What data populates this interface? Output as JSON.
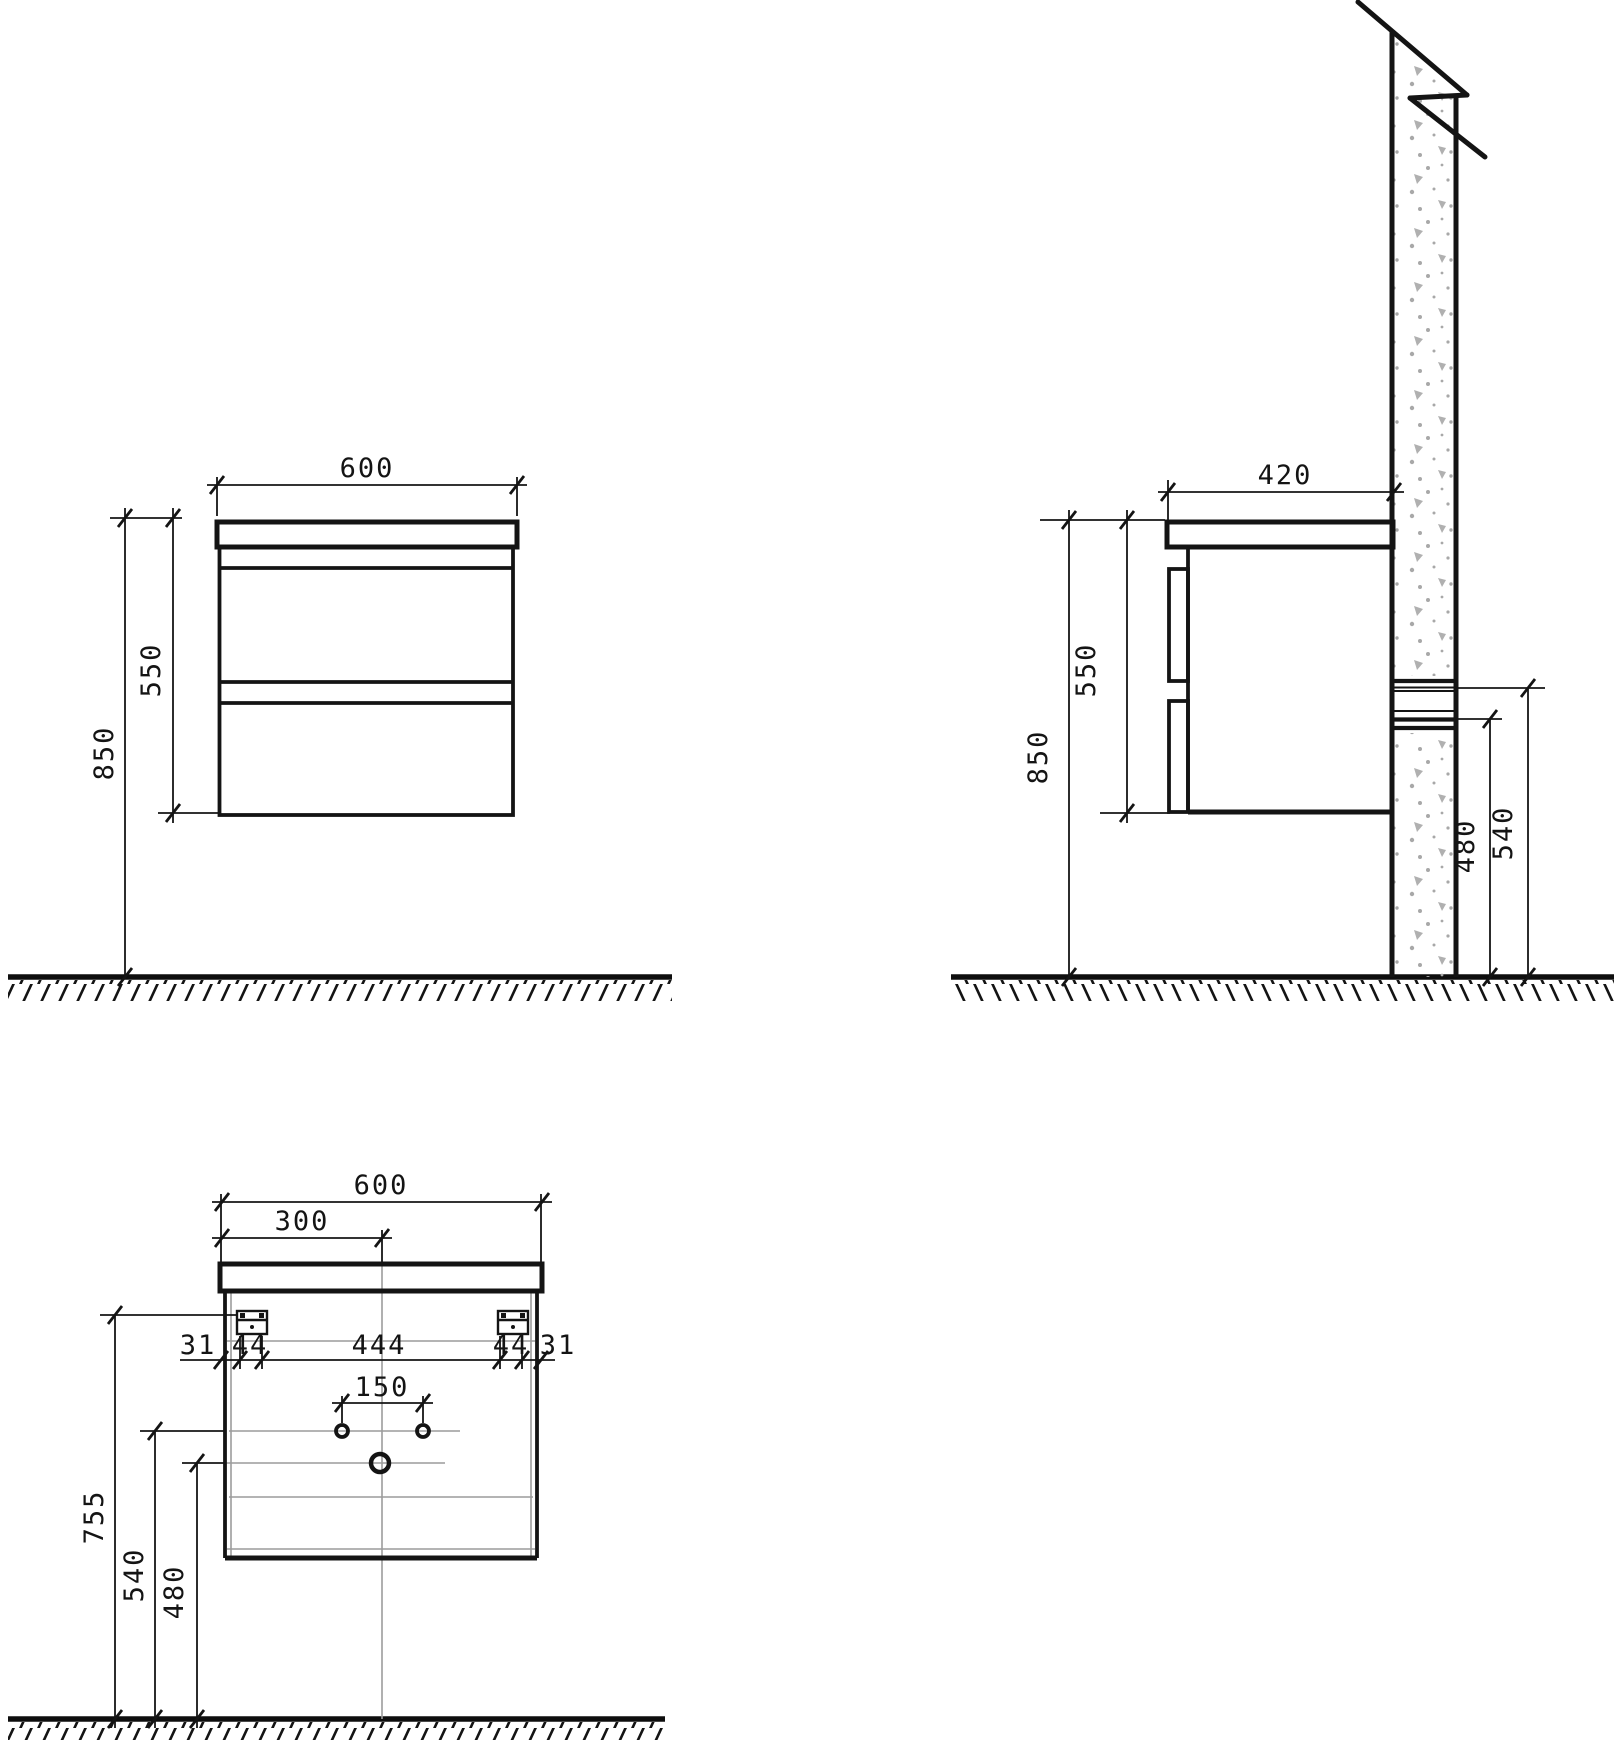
{
  "front_view": {
    "width": "600",
    "cabinet_height": "550",
    "mount_height": "850"
  },
  "side_view": {
    "depth": "420",
    "cabinet_height": "550",
    "mount_height": "850",
    "outlet_upper": "540",
    "outlet_lower": "480"
  },
  "back_view": {
    "width": "600",
    "center_offset": "300",
    "margin_left": "31",
    "bracket_left": "44",
    "bracket_span": "444",
    "bracket_right": "44",
    "margin_right": "31",
    "faucet_spacing": "150",
    "bracket_height": "755",
    "faucet_height": "540",
    "drain_height": "480"
  },
  "colors": {
    "line": "#141414",
    "hidden_line": "#9c9c9c",
    "concrete_fleck": "#b0b0b0",
    "background": "#ffffff"
  }
}
